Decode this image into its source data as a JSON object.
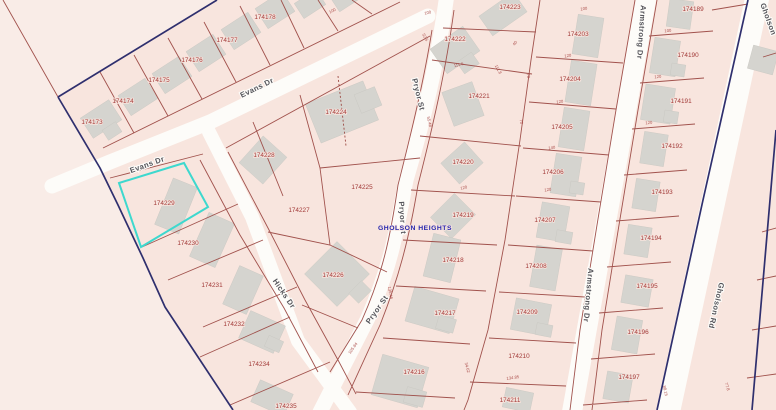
{
  "map": {
    "subdivision_label": {
      "text": "GHOLSON HEIGHTS"
    },
    "selected_parcel": {
      "id": "174229",
      "highlight_color": "#3ed8ce"
    },
    "colors": {
      "background": "#f9ece7",
      "subdivision_fill": "#f8e5de",
      "road_fill": "#fdfcf9",
      "parcel_line": "#9c4a44",
      "boundary_line": "#2f2f6e",
      "building_fill": "#d5d4cf",
      "parcel_text": "#a23a38",
      "street_text": "#54545a",
      "subdivision_text": "#2626ae"
    },
    "street_labels": [
      {
        "name": "Evans Dr",
        "x": 258,
        "y": 90,
        "angle": -26
      },
      {
        "name": "Evans Dr",
        "x": 148,
        "y": 167,
        "angle": -20
      },
      {
        "name": "Pryor St",
        "x": 416,
        "y": 95,
        "angle": 76
      },
      {
        "name": "Pryor St",
        "x": 400,
        "y": 218,
        "angle": 86
      },
      {
        "name": "Pryor St",
        "x": 379,
        "y": 311,
        "angle": -55
      },
      {
        "name": "Hicks Dr",
        "x": 282,
        "y": 295,
        "angle": 56
      },
      {
        "name": "Armstrong Dr",
        "x": 639,
        "y": 32,
        "angle": 94
      },
      {
        "name": "Armstrong Dr",
        "x": 586,
        "y": 295,
        "angle": 95
      },
      {
        "name": "Gholson",
        "x": 766,
        "y": 20,
        "angle": 70
      },
      {
        "name": "Gholson Rd",
        "x": 714,
        "y": 305,
        "angle": 103
      }
    ],
    "parcel_labels": [
      {
        "id": "174173",
        "x": 92,
        "y": 124
      },
      {
        "id": "174174",
        "x": 123,
        "y": 103
      },
      {
        "id": "174175",
        "x": 159,
        "y": 82
      },
      {
        "id": "174176",
        "x": 192,
        "y": 62
      },
      {
        "id": "174177",
        "x": 227,
        "y": 42
      },
      {
        "id": "174178",
        "x": 265,
        "y": 19
      },
      {
        "id": "174223",
        "x": 510,
        "y": 9
      },
      {
        "id": "174222",
        "x": 455,
        "y": 41
      },
      {
        "id": "174221",
        "x": 479,
        "y": 98
      },
      {
        "id": "174224",
        "x": 336,
        "y": 114
      },
      {
        "id": "174228",
        "x": 264,
        "y": 157
      },
      {
        "id": "174225",
        "x": 362,
        "y": 189
      },
      {
        "id": "174227",
        "x": 299,
        "y": 212
      },
      {
        "id": "174229",
        "x": 164,
        "y": 205
      },
      {
        "id": "174230",
        "x": 188,
        "y": 245
      },
      {
        "id": "174231",
        "x": 212,
        "y": 287
      },
      {
        "id": "174232",
        "x": 234,
        "y": 326
      },
      {
        "id": "174234",
        "x": 259,
        "y": 366
      },
      {
        "id": "174235",
        "x": 286,
        "y": 408
      },
      {
        "id": "174226",
        "x": 333,
        "y": 277
      },
      {
        "id": "174220",
        "x": 463,
        "y": 164
      },
      {
        "id": "174219",
        "x": 463,
        "y": 217
      },
      {
        "id": "174218",
        "x": 453,
        "y": 262
      },
      {
        "id": "174217",
        "x": 445,
        "y": 315
      },
      {
        "id": "174216",
        "x": 414,
        "y": 374
      },
      {
        "id": "174207",
        "x": 545,
        "y": 222
      },
      {
        "id": "174208",
        "x": 536,
        "y": 268
      },
      {
        "id": "174209",
        "x": 527,
        "y": 314
      },
      {
        "id": "174210",
        "x": 519,
        "y": 358
      },
      {
        "id": "174211",
        "x": 510,
        "y": 402
      },
      {
        "id": "174203",
        "x": 578,
        "y": 36
      },
      {
        "id": "174204",
        "x": 570,
        "y": 81
      },
      {
        "id": "174205",
        "x": 562,
        "y": 129
      },
      {
        "id": "174206",
        "x": 553,
        "y": 174
      },
      {
        "id": "174189",
        "x": 693,
        "y": 11
      },
      {
        "id": "174190",
        "x": 688,
        "y": 57
      },
      {
        "id": "174191",
        "x": 681,
        "y": 103
      },
      {
        "id": "174192",
        "x": 672,
        "y": 148
      },
      {
        "id": "174193",
        "x": 662,
        "y": 194
      },
      {
        "id": "174194",
        "x": 651,
        "y": 240
      },
      {
        "id": "174195",
        "x": 647,
        "y": 288
      },
      {
        "id": "174196",
        "x": 638,
        "y": 334
      },
      {
        "id": "174197",
        "x": 629,
        "y": 379
      }
    ],
    "dimension_labels": [
      {
        "text": "100",
        "x": 333,
        "y": 12,
        "angle": -27
      },
      {
        "text": "100",
        "x": 428,
        "y": 14,
        "angle": -12
      },
      {
        "text": "52.5",
        "x": 424,
        "y": 38,
        "angle": 62
      },
      {
        "text": "111.6",
        "x": 459,
        "y": 66,
        "angle": -15
      },
      {
        "text": "40",
        "x": 516,
        "y": 44,
        "angle": -55
      },
      {
        "text": "111.8",
        "x": 497,
        "y": 70,
        "angle": 62
      },
      {
        "text": "100",
        "x": 584,
        "y": 10,
        "angle": -8
      },
      {
        "text": "120",
        "x": 568,
        "y": 57,
        "angle": -8
      },
      {
        "text": "120",
        "x": 560,
        "y": 103,
        "angle": -8
      },
      {
        "text": "140",
        "x": 552,
        "y": 149,
        "angle": -8
      },
      {
        "text": "120",
        "x": 548,
        "y": 191,
        "angle": -8
      },
      {
        "text": "120",
        "x": 464,
        "y": 189,
        "angle": -12
      },
      {
        "text": "70",
        "x": 527,
        "y": 76,
        "angle": 80
      },
      {
        "text": "70",
        "x": 520,
        "y": 122,
        "angle": 80
      },
      {
        "text": "100",
        "x": 668,
        "y": 32,
        "angle": -6
      },
      {
        "text": "120",
        "x": 658,
        "y": 78,
        "angle": -6
      },
      {
        "text": "120",
        "x": 649,
        "y": 124,
        "angle": -6
      },
      {
        "text": "55.48",
        "x": 428,
        "y": 122,
        "angle": 78
      },
      {
        "text": "135.46",
        "x": 389,
        "y": 293,
        "angle": 80
      },
      {
        "text": "105.84",
        "x": 354,
        "y": 349,
        "angle": -55
      },
      {
        "text": "34.62",
        "x": 466,
        "y": 368,
        "angle": 75
      },
      {
        "text": "134.85",
        "x": 513,
        "y": 379,
        "angle": -8
      },
      {
        "text": "88.15",
        "x": 664,
        "y": 391,
        "angle": 78
      },
      {
        "text": "77.8",
        "x": 726,
        "y": 387,
        "angle": 72
      }
    ]
  }
}
